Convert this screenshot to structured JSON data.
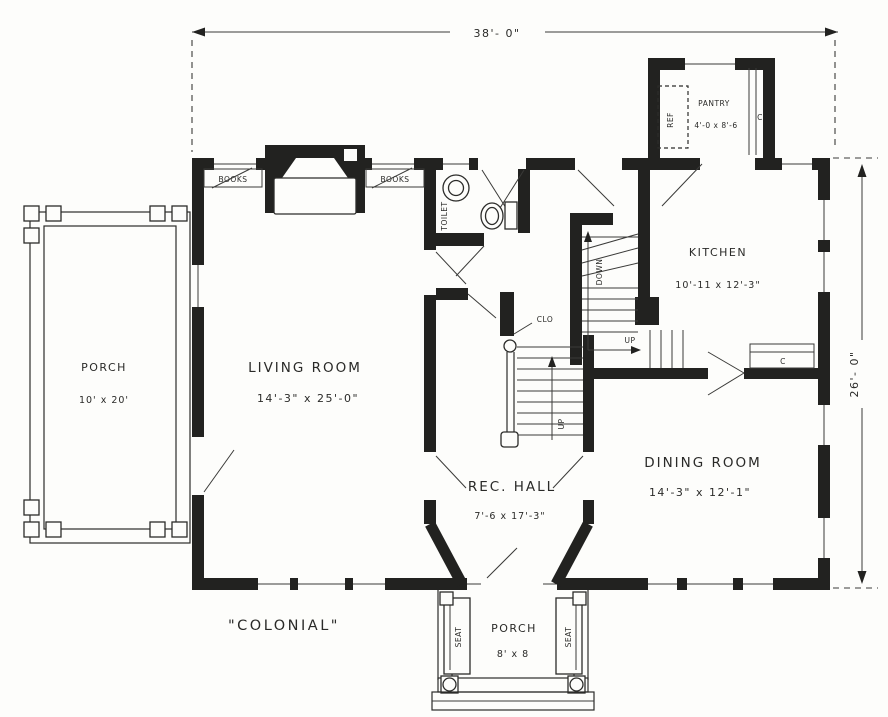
{
  "plan": {
    "style_title": "\"COLONIAL\"",
    "overall_dimensions": {
      "width": "38'- 0\"",
      "depth": "26'- 0\""
    },
    "rooms": {
      "living_room": {
        "name": "LIVING ROOM",
        "size": "14'-3\" x 25'-0\""
      },
      "dining_room": {
        "name": "DINING ROOM",
        "size": "14'-3\" x 12'-1\""
      },
      "kitchen": {
        "name": "KITCHEN",
        "size": "10'-11 x 12'-3\""
      },
      "rec_hall": {
        "name": "REC. HALL",
        "size": "7'-6 x 17'-3\""
      },
      "pantry": {
        "name": "PANTRY",
        "size": "4'-0 x 8'-6"
      },
      "side_porch": {
        "name": "PORCH",
        "size": "10' x 20'"
      },
      "front_porch": {
        "name": "PORCH",
        "size": "8' x 8"
      },
      "toilet": {
        "name": "TOILET"
      },
      "closet": {
        "name": "CLO"
      }
    },
    "annotations": {
      "books_left": "BOOKS",
      "books_right": "BOOKS",
      "refrigerator": "REF",
      "pantry_cupboard": "C",
      "kitchen_cabinet": "C",
      "back_stairs_down": "DOWN",
      "back_stairs_up": "UP",
      "main_stairs_up": "UP",
      "seat_left": "SEAT",
      "seat_right": "SEAT"
    },
    "colors": {
      "ink": "#222220",
      "paper": "#fdfdfb"
    }
  }
}
